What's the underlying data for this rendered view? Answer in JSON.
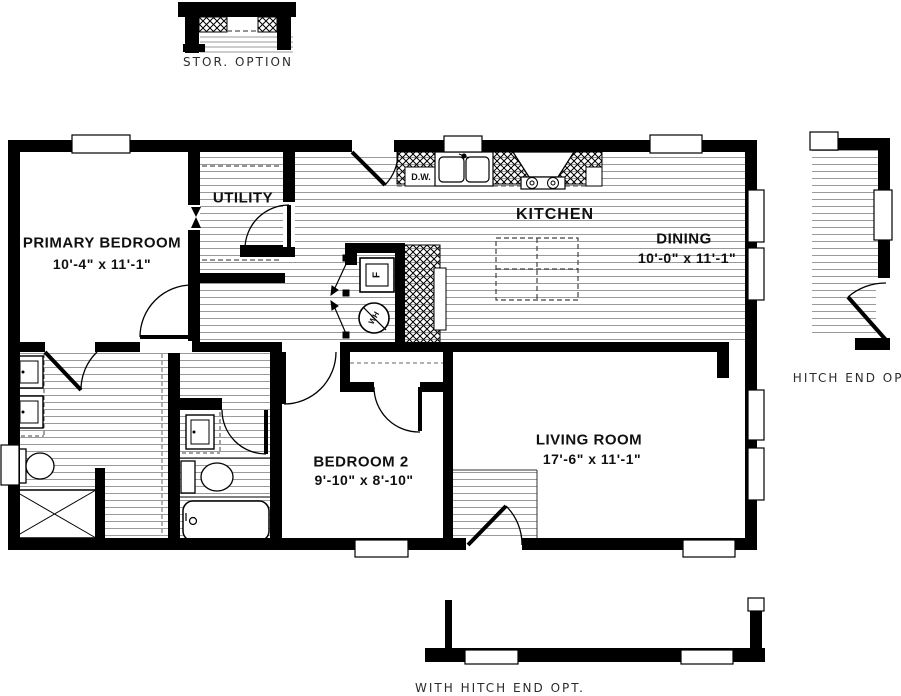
{
  "plan": {
    "rooms": {
      "primary_bedroom": {
        "name": "PRIMARY BEDROOM",
        "dims": "10'-4\" x  11'-1\""
      },
      "utility": {
        "name": "UTILITY"
      },
      "kitchen": {
        "name": "KITCHEN"
      },
      "dining": {
        "name": "DINING",
        "dims": "10'-0\" x  11'-1\""
      },
      "bedroom_2": {
        "name": "BEDROOM 2",
        "dims": "9'-10\" x  8'-10\""
      },
      "living_room": {
        "name": "LIVING ROOM",
        "dims": "17'-6\" x  11'-1\""
      }
    },
    "appliances": {
      "dishwasher": "D.W.",
      "furnace": "F",
      "water_heater": "WH"
    },
    "options": {
      "storage": "STOR.  OPTION",
      "hitch_end": "HITCH  END  OPT.",
      "with_hitch_end": "WITH  HITCH  END  OPT."
    },
    "colors": {
      "wall": "#000000",
      "floor_hatch": "#9a9a9a",
      "text": "#101010"
    }
  }
}
